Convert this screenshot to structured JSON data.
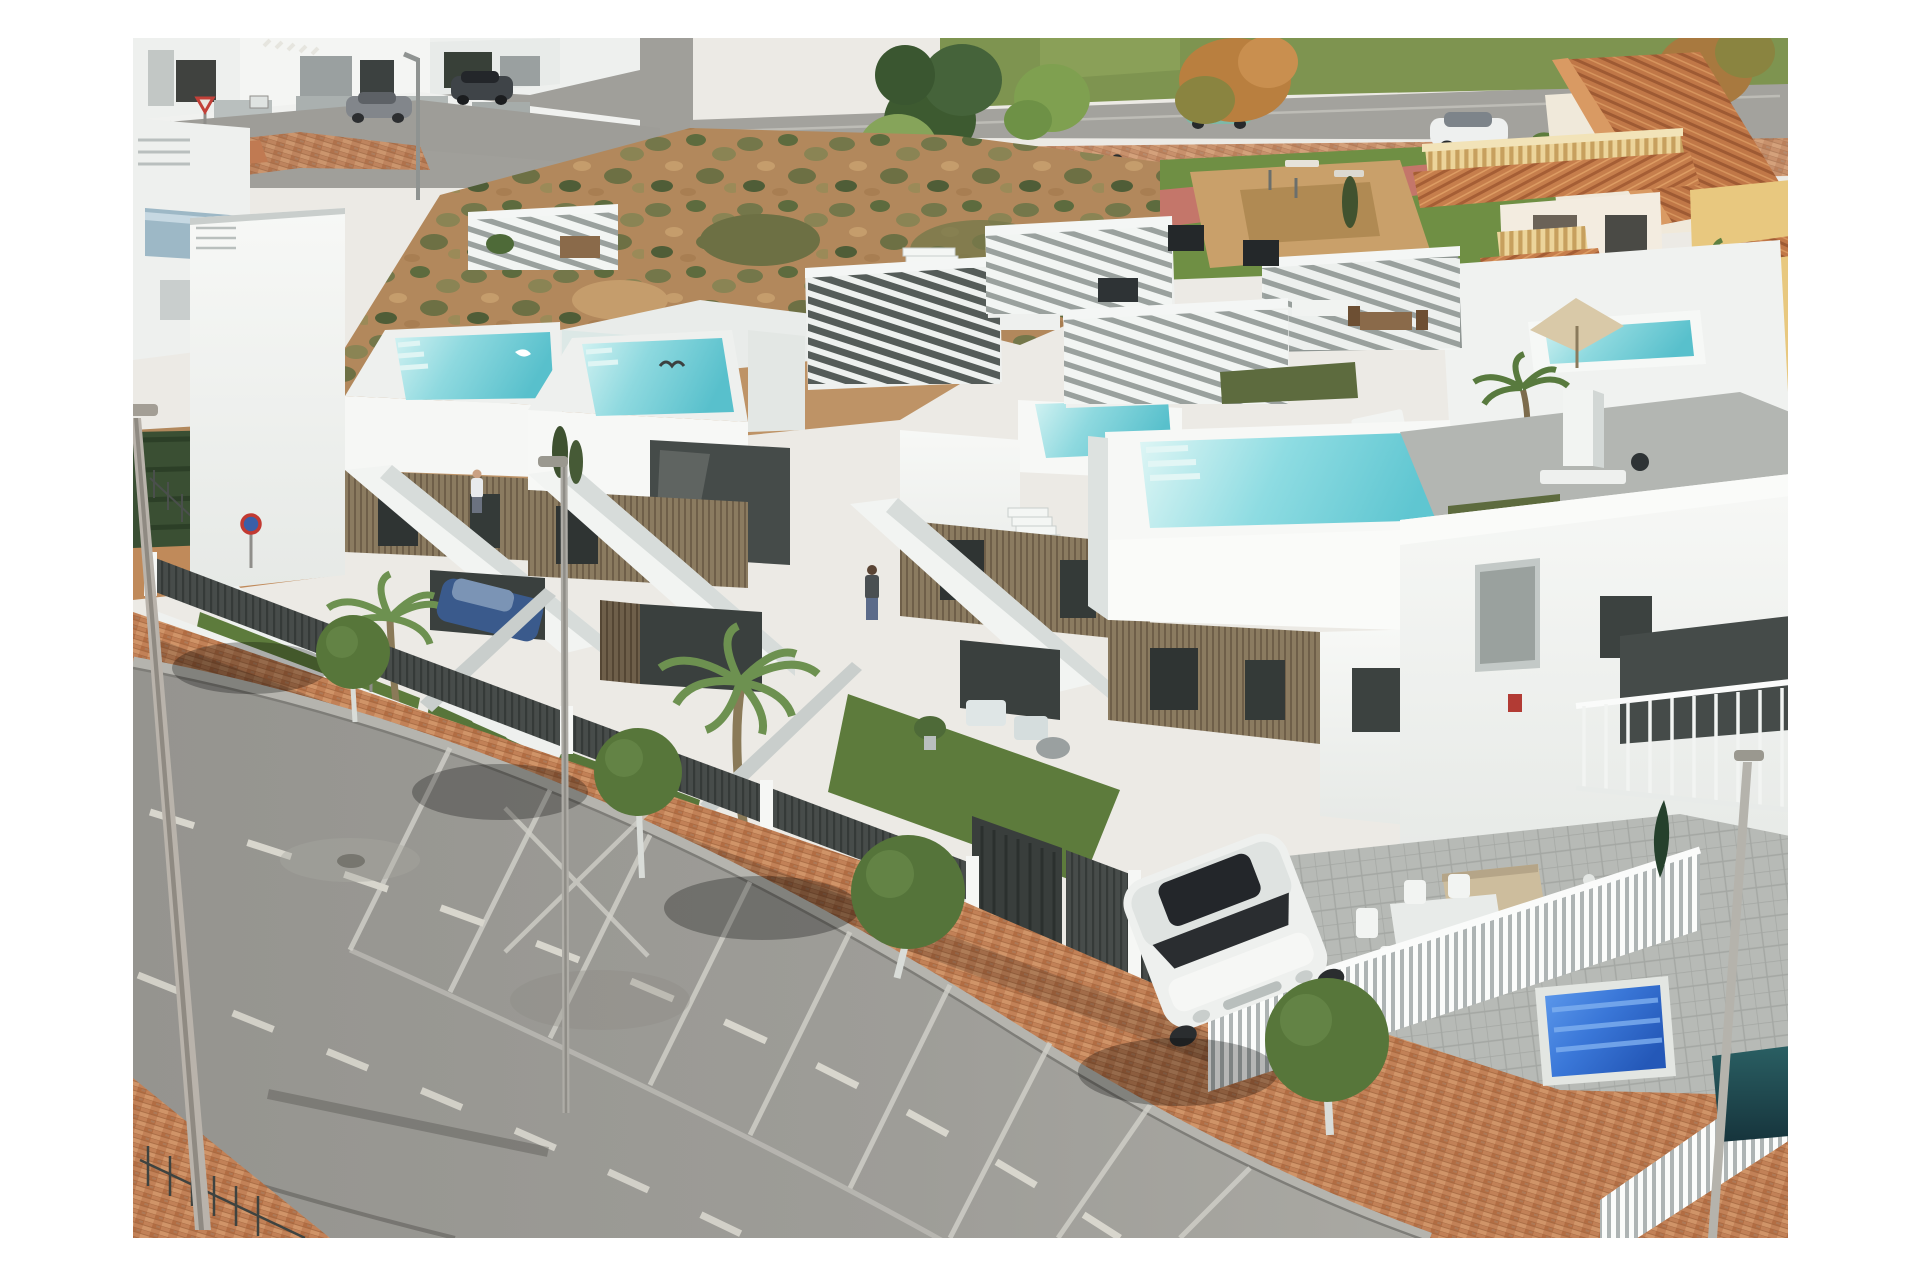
{
  "meta": {
    "kind": "aerial-photograph-render",
    "alt": "Aerial drone view of a row of modern white new-build townhouses with brown timber-slat facades, rooftop solariums with small turquoise pools and white pergolas, fenced artificial-grass gardens, a brick-paved sidewalk with round topiary trees, a wide asphalt road with parking bays in the foreground, a white SUV parked by a neighbouring white apartment building with a blue covered pool, a Mediterranean villa with terracotta roofs behind, and scrubland with another street at the top"
  },
  "palette": {
    "page_bg": "#ffffff",
    "photo_base": "#eceae5",
    "asphalt": "#9b9a95",
    "asphalt_light": "#a8a7a1",
    "road_marking": "#d8d6cd",
    "sidewalk_brick": "#c28157",
    "curb": "#b5b4ae",
    "wall_white": "#f3f5f3",
    "wall_shade": "#d7dcdb",
    "wood_slat": "#8b7b60",
    "wood_slat_dark": "#6d5e49",
    "fence_dark": "#474c4a",
    "lawn_green": "#5d7b3c",
    "palm_green": "#6d9150",
    "topiary_green": "#57763a",
    "pool_turquoise": "#6fcfd8",
    "pool_blue_cover": "#2f6fd6",
    "pool_dark_teal": "#1f4d52",
    "scrub_tan": "#b2885c",
    "scrub_olive": "#6d7044",
    "terracotta": "#c67e4c",
    "villa_cream": "#f0e9da",
    "baluster_cream": "#e8cf96",
    "park_sand": "#c9a06a",
    "path_pink": "#c4766a"
  },
  "scene": {
    "townhouse_units": 4,
    "rooftop_pools": 5,
    "pergolas": 5,
    "topiary_trees": 4,
    "street_lights": 6,
    "people": 2,
    "vehicles": {
      "white_suv": 1,
      "blue_car": 1,
      "background_cars": 4
    },
    "road": {
      "parking_bay_lines": 9,
      "dashed_lane_lines": 2
    },
    "pools_other": {
      "blue_covered_pool": 1,
      "dark_pool": 1
    }
  }
}
